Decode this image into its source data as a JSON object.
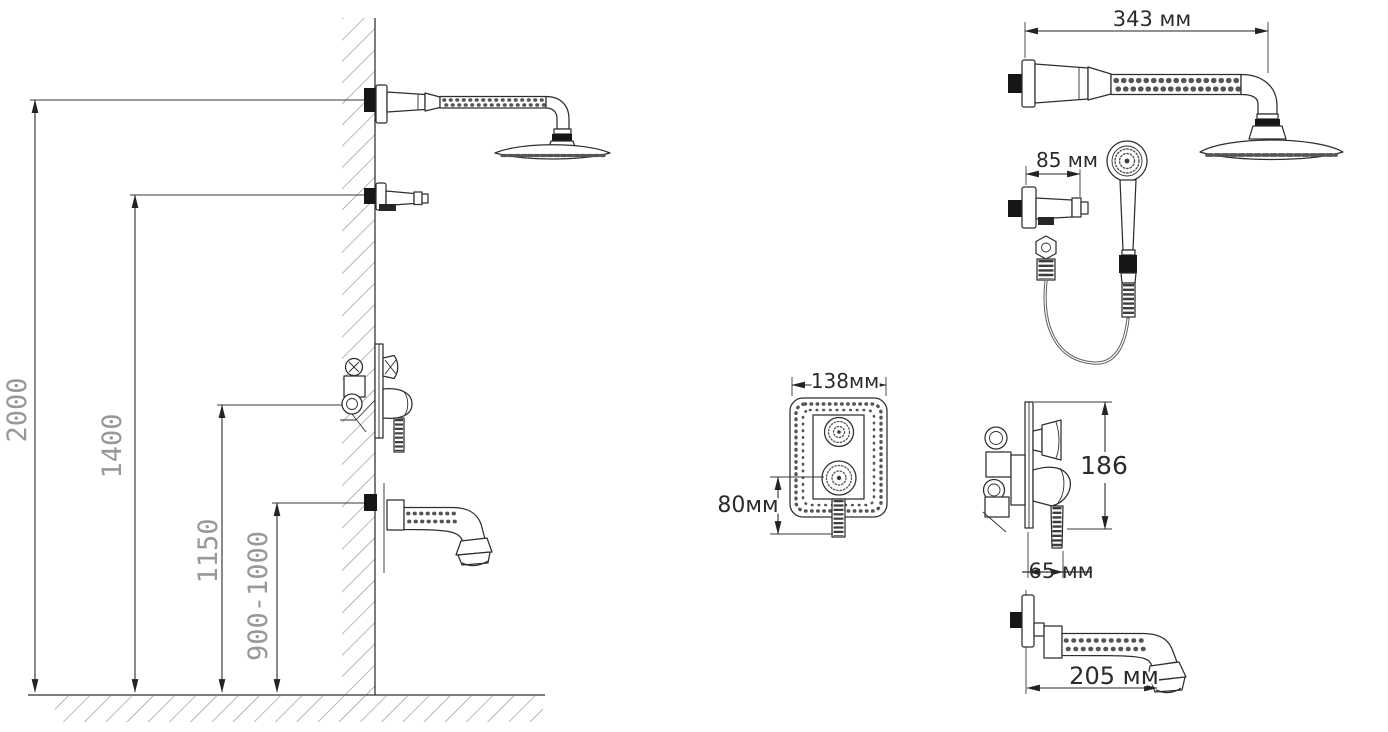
{
  "colors": {
    "background": "#ffffff",
    "line": "#2e2e2e",
    "hatch": "#8a8a8a",
    "left_dim_label": "#98989a",
    "right_dim_label": "#2b2b2b"
  },
  "installation_view": {
    "dim_total_height": "2000",
    "dim_hand_shower_holder_height": "1400",
    "dim_mixer_height": "1150",
    "dim_spout_height": "900-1000"
  },
  "component_view": {
    "dim_shower_arm_length": "343 мм",
    "dim_holder_length": "85 мм",
    "dim_panel_width": "138мм",
    "dim_panel_height": "80мм",
    "dim_mixer_height": "186",
    "dim_mixer_depth": "65 мм",
    "dim_spout_length": "205 мм"
  }
}
